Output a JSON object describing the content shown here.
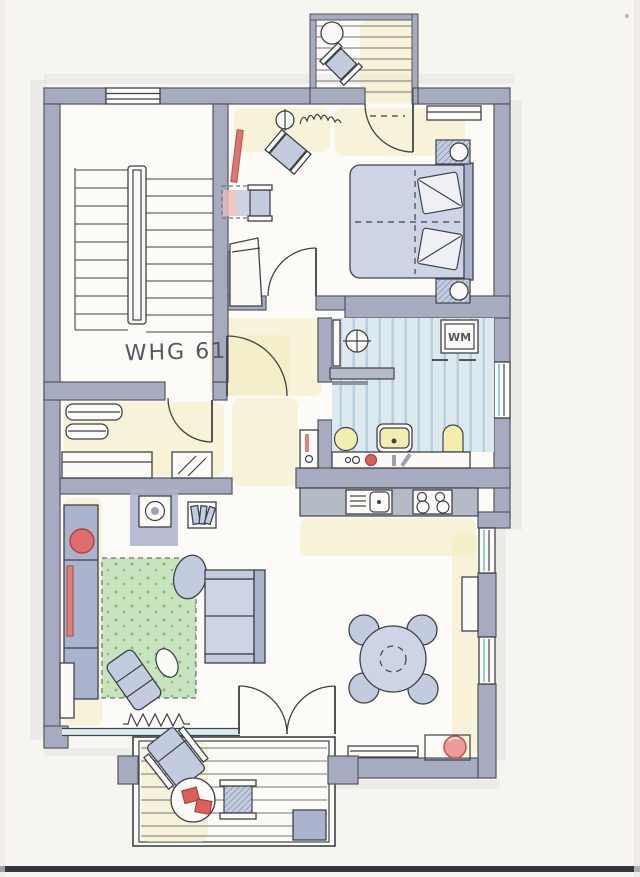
{
  "plan": {
    "apartment_label": "WHG 61",
    "washing_machine_label": "WM"
  },
  "colors": {
    "paper": "#f7f5f0",
    "floor": "#fcfbf7",
    "wall": "#a7abbf",
    "wall_outline": "#54565f",
    "line": "#3f424a",
    "furniture": "#c3cbdf",
    "furniture_light": "#cdd4e5",
    "furniture_dark": "#aab3cd",
    "white_item": "#fbfaf6",
    "counter_grey": "#b5bac7",
    "rug_green": "#b5dcab",
    "rug_dot": "#6fae62",
    "accent_red": "#d9605c",
    "accent_soft": "#ec9b98",
    "fixture_yellow": "#f2eeb0",
    "tile_blue": "#dcе9еf",
    "tile_blue_fix": "#dce9ef",
    "tile_stripe": "#b7d0dc",
    "tint_yellow": "#f2e9ba",
    "glass_teal": "#8fd0d6",
    "label_ink": "#54585f",
    "scan_bar": "#33363d"
  }
}
